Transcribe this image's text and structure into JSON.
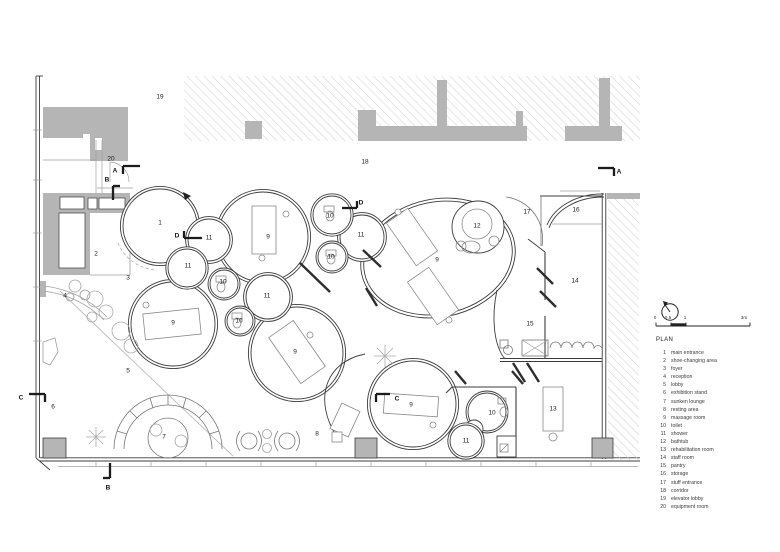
{
  "legend": {
    "title": "PLAN",
    "items": [
      {
        "num": "1",
        "label": "main entrance"
      },
      {
        "num": "2",
        "label": "shoe-changing area"
      },
      {
        "num": "3",
        "label": "foyer"
      },
      {
        "num": "4",
        "label": "reception"
      },
      {
        "num": "5",
        "label": "lobby"
      },
      {
        "num": "6",
        "label": "exhibition stand"
      },
      {
        "num": "7",
        "label": "sunken lounge"
      },
      {
        "num": "8",
        "label": "resting area"
      },
      {
        "num": "9",
        "label": "massage room"
      },
      {
        "num": "10",
        "label": "toilet"
      },
      {
        "num": "11",
        "label": "shower"
      },
      {
        "num": "12",
        "label": "bathtub"
      },
      {
        "num": "13",
        "label": "rehabilitation room"
      },
      {
        "num": "14",
        "label": "staff room"
      },
      {
        "num": "15",
        "label": "pantry"
      },
      {
        "num": "16",
        "label": "storage"
      },
      {
        "num": "17",
        "label": "stuff entrance"
      },
      {
        "num": "18",
        "label": "corridor"
      },
      {
        "num": "19",
        "label": "elevator lobby"
      },
      {
        "num": "20",
        "label": "equipment room"
      }
    ]
  },
  "plan_labels": [
    {
      "text": "1",
      "x": 160,
      "y": 223
    },
    {
      "text": "2",
      "x": 96,
      "y": 254
    },
    {
      "text": "3",
      "x": 128,
      "y": 278
    },
    {
      "text": "4",
      "x": 65,
      "y": 296
    },
    {
      "text": "5",
      "x": 128,
      "y": 371
    },
    {
      "text": "6",
      "x": 53,
      "y": 407
    },
    {
      "text": "7",
      "x": 164,
      "y": 437
    },
    {
      "text": "8",
      "x": 317,
      "y": 434
    },
    {
      "text": "9",
      "x": 268,
      "y": 237
    },
    {
      "text": "9",
      "x": 173,
      "y": 323
    },
    {
      "text": "9",
      "x": 295,
      "y": 352
    },
    {
      "text": "9",
      "x": 437,
      "y": 260
    },
    {
      "text": "9",
      "x": 411,
      "y": 405
    },
    {
      "text": "10",
      "x": 330,
      "y": 216
    },
    {
      "text": "10",
      "x": 331,
      "y": 257
    },
    {
      "text": "10",
      "x": 223,
      "y": 282
    },
    {
      "text": "10",
      "x": 239,
      "y": 321
    },
    {
      "text": "10",
      "x": 492,
      "y": 413
    },
    {
      "text": "11",
      "x": 209,
      "y": 238
    },
    {
      "text": "11",
      "x": 188,
      "y": 266
    },
    {
      "text": "11",
      "x": 361,
      "y": 235
    },
    {
      "text": "11",
      "x": 267,
      "y": 296
    },
    {
      "text": "11",
      "x": 466,
      "y": 441
    },
    {
      "text": "12",
      "x": 477,
      "y": 226
    },
    {
      "text": "13",
      "x": 553,
      "y": 409
    },
    {
      "text": "14",
      "x": 575,
      "y": 281
    },
    {
      "text": "15",
      "x": 530,
      "y": 324
    },
    {
      "text": "16",
      "x": 576,
      "y": 210
    },
    {
      "text": "17",
      "x": 527,
      "y": 212
    },
    {
      "text": "18",
      "x": 365,
      "y": 162
    },
    {
      "text": "19",
      "x": 160,
      "y": 97
    },
    {
      "text": "20",
      "x": 111,
      "y": 159
    }
  ],
  "section_markers": [
    {
      "letter": "A",
      "x": 115,
      "y": 171,
      "lines": [
        [
          123,
          166,
          140,
          166
        ],
        [
          123,
          166,
          123,
          174
        ]
      ]
    },
    {
      "letter": "A",
      "x": 619,
      "y": 172,
      "lines": [
        [
          598,
          168,
          614,
          168
        ],
        [
          614,
          168,
          614,
          176
        ]
      ]
    },
    {
      "letter": "B",
      "x": 107,
      "y": 180,
      "lines": [
        [
          113,
          186,
          113,
          200
        ],
        [
          113,
          186,
          120,
          186
        ]
      ]
    },
    {
      "letter": "B",
      "x": 108,
      "y": 488,
      "lines": [
        [
          110,
          463,
          110,
          478
        ],
        [
          103,
          478,
          110,
          478
        ]
      ]
    },
    {
      "letter": "C",
      "x": 21,
      "y": 398,
      "lines": [
        [
          29,
          394,
          45,
          394
        ],
        [
          45,
          394,
          45,
          402
        ]
      ]
    },
    {
      "letter": "C",
      "x": 397,
      "y": 399,
      "lines": [
        [
          376,
          394,
          390,
          394
        ],
        [
          376,
          394,
          376,
          402
        ]
      ]
    },
    {
      "letter": "D",
      "x": 177,
      "y": 236,
      "lines": [
        [
          184,
          238,
          202,
          238
        ],
        [
          184,
          231,
          184,
          238
        ]
      ]
    },
    {
      "letter": "D",
      "x": 361,
      "y": 203,
      "lines": [
        [
          342,
          208,
          357,
          208
        ],
        [
          357,
          201,
          357,
          208
        ]
      ]
    }
  ],
  "scale_bar": {
    "ticks": [
      {
        "label": "0",
        "x": 655
      },
      {
        "label": "0.5",
        "x": 668
      },
      {
        "label": "1",
        "x": 685
      },
      {
        "label": "3m",
        "x": 744
      }
    ]
  },
  "colors": {
    "wall_gray": "#b5b5b5",
    "line_dark": "#3c3c3c",
    "line_mid": "#777777",
    "line_light": "#9f9f9f",
    "hatch": "#d2d2d2",
    "marker": "#1c1c1c"
  }
}
